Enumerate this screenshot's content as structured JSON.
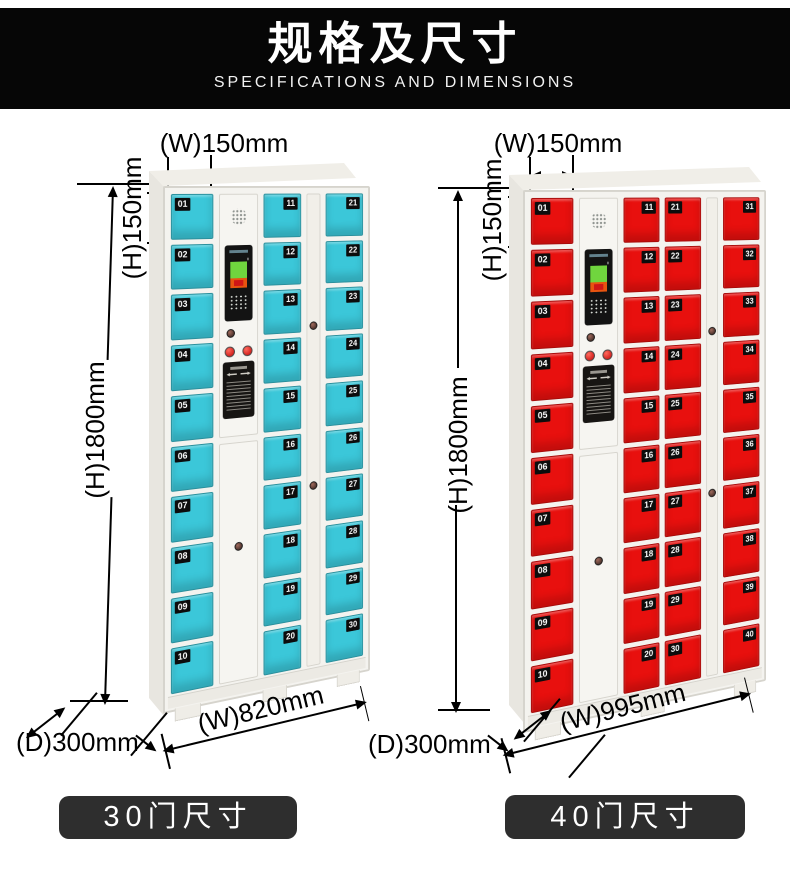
{
  "banner": {
    "title": "规格及尺寸",
    "subtitle": "SPECIFICATIONS AND DIMENSIONS"
  },
  "colors": {
    "banner_bg": "#060606",
    "pill_bg": "#2e2e2e",
    "cyan_door": "#3bc7d9",
    "red_door": "#e8100e"
  },
  "lockers": [
    {
      "name": "30-door locker",
      "label": "30门尺寸",
      "door_color": "#3bc7d9",
      "dims": {
        "door_width": "(W)150mm",
        "door_height": "(H)150mm",
        "height": "(H)1800mm",
        "depth": "(D)300mm",
        "width": "(W)820mm"
      },
      "door_columns": [
        [
          "01",
          "02",
          "03",
          "04",
          "05",
          "06",
          "07",
          "08",
          "09",
          "10"
        ],
        [
          "11",
          "12",
          "13",
          "14",
          "15",
          "16",
          "17",
          "18",
          "19",
          "20"
        ],
        [
          "21",
          "22",
          "23",
          "24",
          "25",
          "26",
          "27",
          "28",
          "29",
          "30"
        ]
      ]
    },
    {
      "name": "40-door locker",
      "label": "40门尺寸",
      "door_color": "#e8100e",
      "dims": {
        "door_width": "(W)150mm",
        "door_height": "(H)150mm",
        "height": "(H)1800mm",
        "depth": "(D)300mm",
        "width": "(W)995mm"
      },
      "door_columns": [
        [
          "01",
          "02",
          "03",
          "04",
          "05",
          "06",
          "07",
          "08",
          "09",
          "10"
        ],
        [
          "11",
          "12",
          "13",
          "14",
          "15",
          "16",
          "17",
          "18",
          "19",
          "20"
        ],
        [
          "21",
          "22",
          "23",
          "24",
          "25",
          "26",
          "27",
          "28",
          "29",
          "30"
        ],
        [
          "31",
          "32",
          "33",
          "34",
          "35",
          "36",
          "37",
          "38",
          "39",
          "40"
        ]
      ]
    }
  ]
}
